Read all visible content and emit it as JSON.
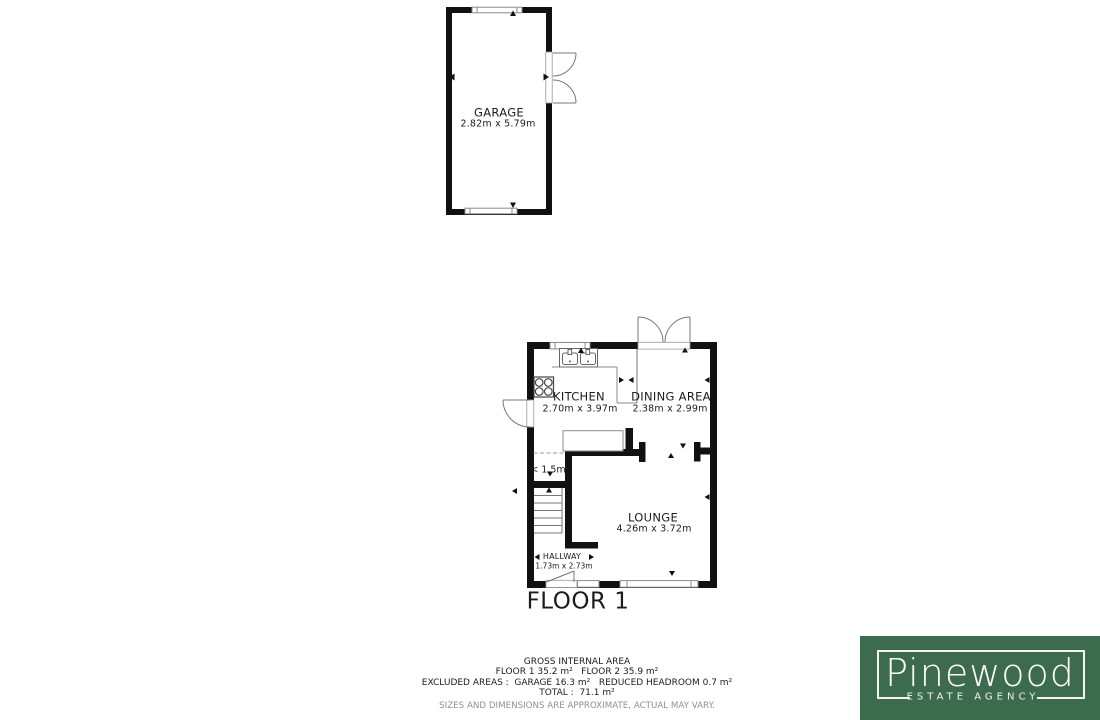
{
  "plan": {
    "garage": {
      "label": "GARAGE",
      "dims": "2.82m x 5.79m"
    },
    "kitchen": {
      "label": "KITCHEN",
      "dims": "2.70m x 3.97m"
    },
    "dining": {
      "label": "DINING AREA",
      "dims": "2.38m x 2.99m"
    },
    "lounge": {
      "label": "LOUNGE",
      "dims": "4.26m x 3.72m"
    },
    "hallway": {
      "label": "HALLWAY",
      "dims": "1.73m x 2.73m"
    },
    "headroom_note": "< 1.5m",
    "floor1_title": "FLOOR 1"
  },
  "footer": {
    "title": "GROSS INTERNAL AREA",
    "floors": "FLOOR 1 35.2 m²   FLOOR 2 35.9 m²",
    "excluded": "EXCLUDED AREAS :  GARAGE 16.3 m²   REDUCED HEADROOM 0.7 m²",
    "total": "TOTAL :  71.1 m²",
    "disclaimer": "SIZES AND DIMENSIONS ARE APPROXIMATE, ACTUAL MAY VARY."
  },
  "logo": {
    "brand": "Pinewood",
    "tagline": "ESTATE AGENCY",
    "bg_color": "#3c6b4e",
    "text_color": "#fdfdfd"
  },
  "colors": {
    "wall": "#111111",
    "thin_line": "#8b8b8b",
    "text": "#1c1c1c",
    "muted": "#909090"
  }
}
